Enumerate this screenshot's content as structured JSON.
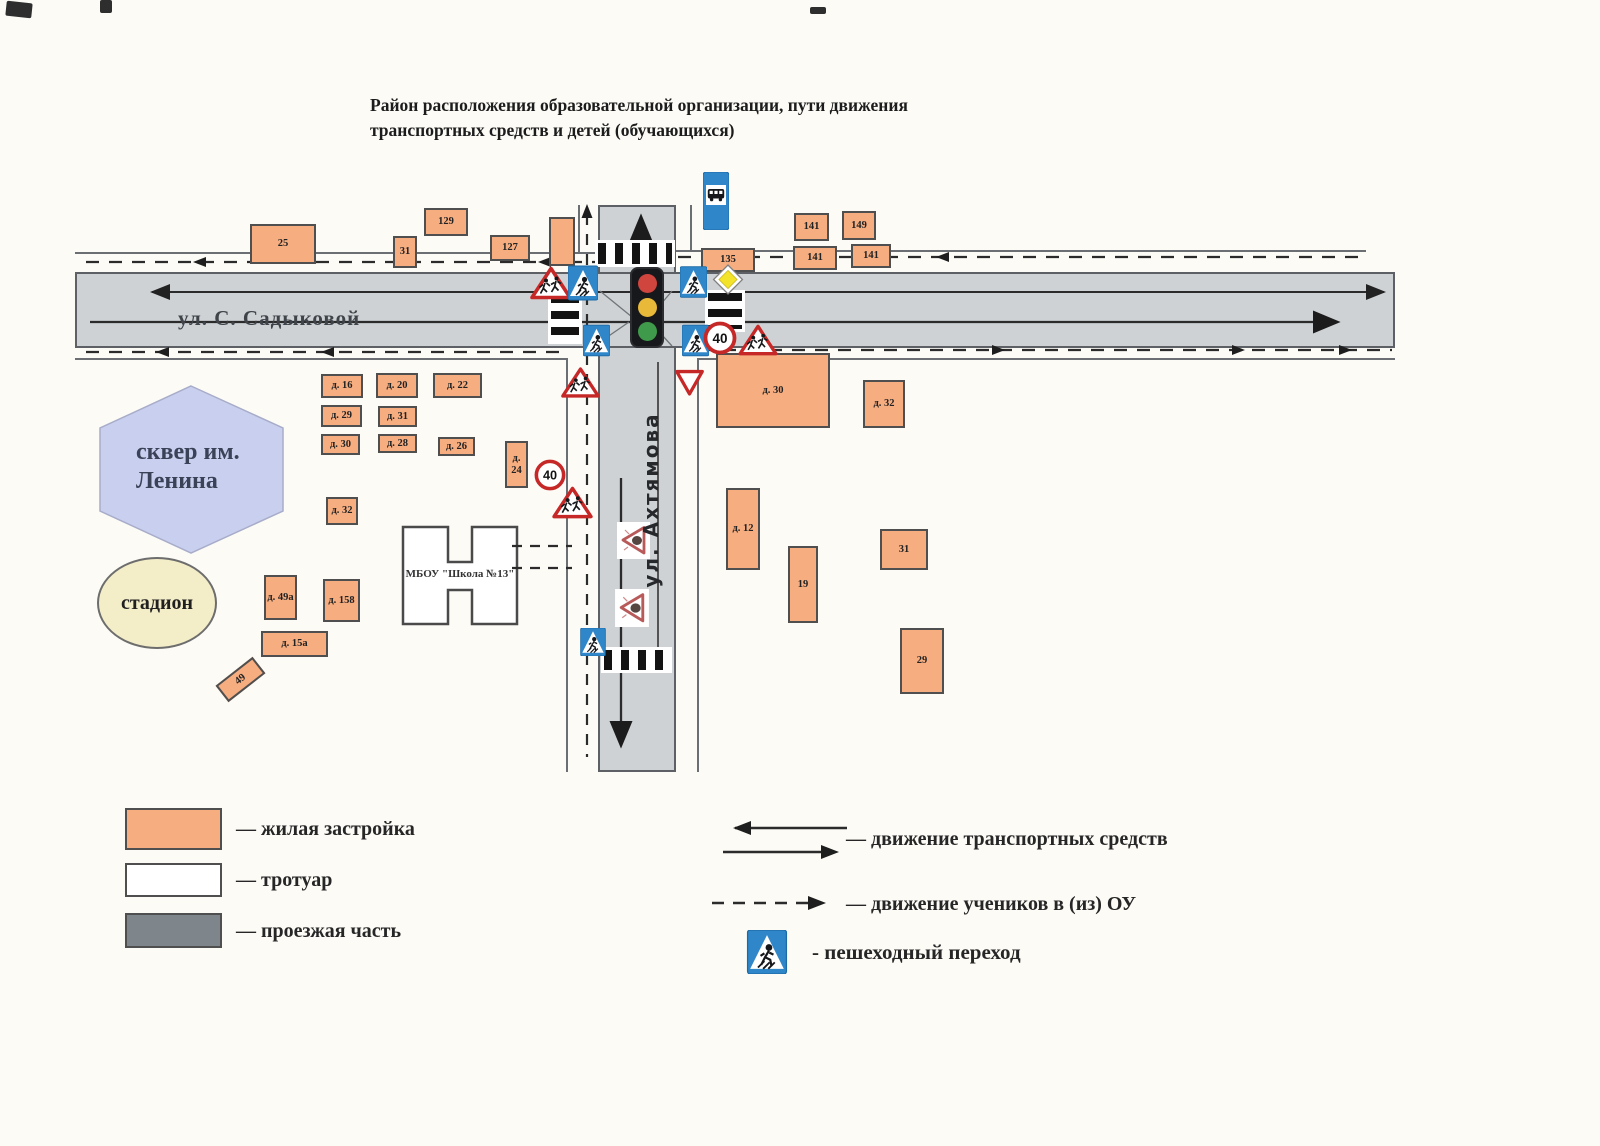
{
  "title": "Район расположения образовательной организации, пути движения транспортных средств и детей (обучающихся)",
  "streets": {
    "sadykova": "ул. С. Садыковой",
    "akhtyamova": "ул. Ахтямова"
  },
  "areas": {
    "park": "сквер им. Ленина",
    "stadium": "стадион",
    "school": "МБОУ \"Школа №13\""
  },
  "speed_limit_label": "40",
  "legend": {
    "residential": "— жилая застройка",
    "sidewalk": "— тротуар",
    "roadway": "— проезжая часть",
    "vehicle_traffic": "— движение транспортных средств",
    "student_route": "— движение учеников в (из) ОУ",
    "crosswalk": "- пешеходный переход"
  },
  "colors": {
    "residential": "#f6ad80",
    "roadway_map": "#ced2d4",
    "roadway_legend": "#7e868b",
    "park": "#c9cfee",
    "stadium": "#f3edc8",
    "sign_blue": "#2f87c9",
    "sign_red": "#c62828",
    "priority_yellow": "#f4e32b"
  },
  "buildings": [
    {
      "label": "25",
      "x": 250,
      "y": 224,
      "w": 66,
      "h": 40
    },
    {
      "label": "31",
      "x": 393,
      "y": 236,
      "w": 24,
      "h": 32
    },
    {
      "label": "129",
      "x": 424,
      "y": 208,
      "w": 44,
      "h": 28
    },
    {
      "label": "127",
      "x": 490,
      "y": 235,
      "w": 40,
      "h": 26
    },
    {
      "label": "",
      "x": 549,
      "y": 217,
      "w": 26,
      "h": 49
    },
    {
      "label": "141",
      "x": 794,
      "y": 213,
      "w": 35,
      "h": 28
    },
    {
      "label": "149",
      "x": 842,
      "y": 211,
      "w": 34,
      "h": 29
    },
    {
      "label": "135",
      "x": 701,
      "y": 248,
      "w": 54,
      "h": 24
    },
    {
      "label": "141",
      "x": 793,
      "y": 246,
      "w": 44,
      "h": 24
    },
    {
      "label": "141",
      "x": 851,
      "y": 244,
      "w": 40,
      "h": 24
    },
    {
      "label": "д. 30",
      "x": 716,
      "y": 353,
      "w": 114,
      "h": 75
    },
    {
      "label": "д. 32",
      "x": 863,
      "y": 380,
      "w": 42,
      "h": 48
    },
    {
      "label": "д. 12",
      "x": 726,
      "y": 488,
      "w": 34,
      "h": 82
    },
    {
      "label": "19",
      "x": 788,
      "y": 546,
      "w": 30,
      "h": 77
    },
    {
      "label": "31",
      "x": 880,
      "y": 529,
      "w": 48,
      "h": 41
    },
    {
      "label": "29",
      "x": 900,
      "y": 628,
      "w": 44,
      "h": 66
    },
    {
      "label": "д. 16",
      "x": 321,
      "y": 374,
      "w": 42,
      "h": 24
    },
    {
      "label": "д. 20",
      "x": 376,
      "y": 373,
      "w": 42,
      "h": 25
    },
    {
      "label": "д. 22",
      "x": 433,
      "y": 373,
      "w": 49,
      "h": 25
    },
    {
      "label": "д. 29",
      "x": 321,
      "y": 405,
      "w": 41,
      "h": 22
    },
    {
      "label": "д. 31",
      "x": 378,
      "y": 406,
      "w": 39,
      "h": 21
    },
    {
      "label": "д. 30",
      "x": 321,
      "y": 434,
      "w": 39,
      "h": 21
    },
    {
      "label": "д. 28",
      "x": 378,
      "y": 434,
      "w": 39,
      "h": 19
    },
    {
      "label": "д. 26",
      "x": 438,
      "y": 437,
      "w": 37,
      "h": 19
    },
    {
      "label": "д. 24",
      "x": 505,
      "y": 441,
      "w": 23,
      "h": 47
    },
    {
      "label": "д. 32",
      "x": 326,
      "y": 497,
      "w": 32,
      "h": 28
    },
    {
      "label": "д. 49а",
      "x": 264,
      "y": 575,
      "w": 33,
      "h": 45
    },
    {
      "label": "д. 158",
      "x": 323,
      "y": 579,
      "w": 37,
      "h": 43
    },
    {
      "label": "д. 15а",
      "x": 261,
      "y": 631,
      "w": 67,
      "h": 26
    },
    {
      "label": "49",
      "x": 217,
      "y": 669,
      "w": 47,
      "h": 21,
      "rot": -38
    }
  ],
  "signs": [
    {
      "type": "bus_stop",
      "x": 703,
      "y": 172,
      "w": 26,
      "h": 58
    },
    {
      "type": "children_warning",
      "x": 530,
      "y": 266,
      "w": 42,
      "h": 34
    },
    {
      "type": "ped_crossing",
      "x": 568,
      "y": 262,
      "w": 30,
      "h": 42
    },
    {
      "type": "ped_crossing",
      "x": 583,
      "y": 317,
      "w": 27,
      "h": 47
    },
    {
      "type": "ped_crossing",
      "x": 680,
      "y": 262,
      "w": 27,
      "h": 40
    },
    {
      "type": "ped_crossing",
      "x": 682,
      "y": 317,
      "w": 27,
      "h": 47
    },
    {
      "type": "priority_road",
      "x": 712,
      "y": 263,
      "w": 32,
      "h": 33
    },
    {
      "type": "speed_limit_40",
      "x": 703,
      "y": 321,
      "w": 34,
      "h": 34
    },
    {
      "type": "children_warning",
      "x": 738,
      "y": 324,
      "w": 40,
      "h": 32
    },
    {
      "type": "give_way",
      "x": 674,
      "y": 367,
      "w": 31,
      "h": 31
    },
    {
      "type": "children_warning",
      "x": 561,
      "y": 366,
      "w": 39,
      "h": 33
    },
    {
      "type": "speed_limit_40",
      "x": 534,
      "y": 459,
      "w": 32,
      "h": 32
    },
    {
      "type": "children_warning",
      "x": 551,
      "y": 486,
      "w": 43,
      "h": 33
    },
    {
      "type": "road_children_marking",
      "x": 617,
      "y": 522,
      "w": 33,
      "h": 37
    },
    {
      "type": "road_children_marking",
      "x": 615,
      "y": 589,
      "w": 34,
      "h": 38
    },
    {
      "type": "ped_crossing",
      "x": 580,
      "y": 628,
      "w": 26,
      "h": 28
    }
  ],
  "crosswalks": [
    {
      "o": "v",
      "x": 595,
      "y": 240,
      "w": 80,
      "h": 27
    },
    {
      "o": "v",
      "x": 601,
      "y": 647,
      "w": 71,
      "h": 26
    },
    {
      "o": "h",
      "x": 548,
      "y": 292,
      "w": 34,
      "h": 52
    },
    {
      "o": "h",
      "x": 705,
      "y": 290,
      "w": 40,
      "h": 42
    }
  ]
}
